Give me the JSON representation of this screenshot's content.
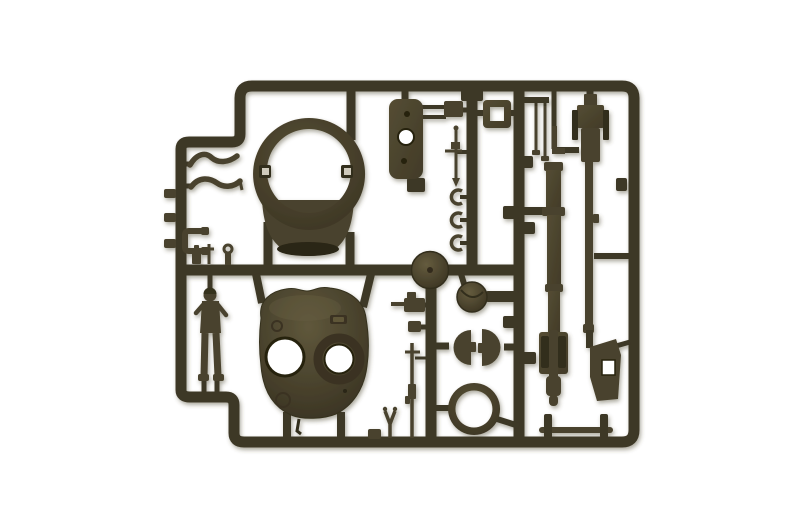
{
  "meta": {
    "image_type": "photograph",
    "subject": "Injection-molded plastic model kit sprue (parts tree) of olive-drab tank components photographed on a white background",
    "orientation": "landscape"
  },
  "colors": {
    "background": "#ffffff",
    "runner": "#3e3726",
    "part": "#4a432d",
    "part_light": "#5e5639",
    "part_dark": "#332d1d",
    "hole_rim": "#26210f",
    "shadow": "#4a452f"
  },
  "sprue": {
    "material": "olive drab styrene plastic",
    "parts": [
      {
        "id": "sprue-frame",
        "desc": "outer rectangular runner frame with rounded corners"
      },
      {
        "id": "turret-ring",
        "desc": "large circular turret ring with collar and two inner tabs"
      },
      {
        "id": "turret-shell",
        "desc": "tank turret upper shell with two round hatch openings"
      },
      {
        "id": "crew-figure",
        "desc": "standing tank crewman figure"
      },
      {
        "id": "hull-side-plate",
        "desc": "rounded rectangular plate with one large and two small holes"
      },
      {
        "id": "square-hatch-frame",
        "desc": "small square frame with square opening"
      },
      {
        "id": "detail-box",
        "desc": "small rectangular detail block"
      },
      {
        "id": "antenna",
        "desc": "thin antenna rod with cross arms"
      },
      {
        "id": "clamp-hooks",
        "desc": "three small C-shaped clamps"
      },
      {
        "id": "thin-rods",
        "desc": "pair of thin hanging rods"
      },
      {
        "id": "machine-gun",
        "desc": "heavy machine gun with long barrel"
      },
      {
        "id": "main-gun-barrel",
        "desc": "long stepped main gun barrel with breech block"
      },
      {
        "id": "tow-bar",
        "desc": "thin horizontal tow bar held by two clips"
      },
      {
        "id": "angular-plate",
        "desc": "angular bracket plate with rectangular opening"
      },
      {
        "id": "commander-hatch",
        "desc": "small round hatch disc"
      },
      {
        "id": "hatch-halves",
        "desc": "two half-round hatch doors facing each other"
      },
      {
        "id": "mounting-ring",
        "desc": "open circular mounting ring"
      },
      {
        "id": "idler-wheel",
        "desc": "solid round wheel on the middle runner"
      },
      {
        "id": "bow-gun",
        "desc": "small gun mount with protruding barrel"
      },
      {
        "id": "rifle",
        "desc": "long thin rifle with fittings"
      },
      {
        "id": "wrench",
        "desc": "tiny Y-shaped tool"
      },
      {
        "id": "levers",
        "desc": "two curved lever arms"
      },
      {
        "id": "u-bracket",
        "desc": "U-shaped bracket"
      },
      {
        "id": "periscopes",
        "desc": "three tiny periscope pieces on the middle runner"
      },
      {
        "id": "runner-knobs",
        "desc": "small knobs along the left runner"
      }
    ]
  }
}
